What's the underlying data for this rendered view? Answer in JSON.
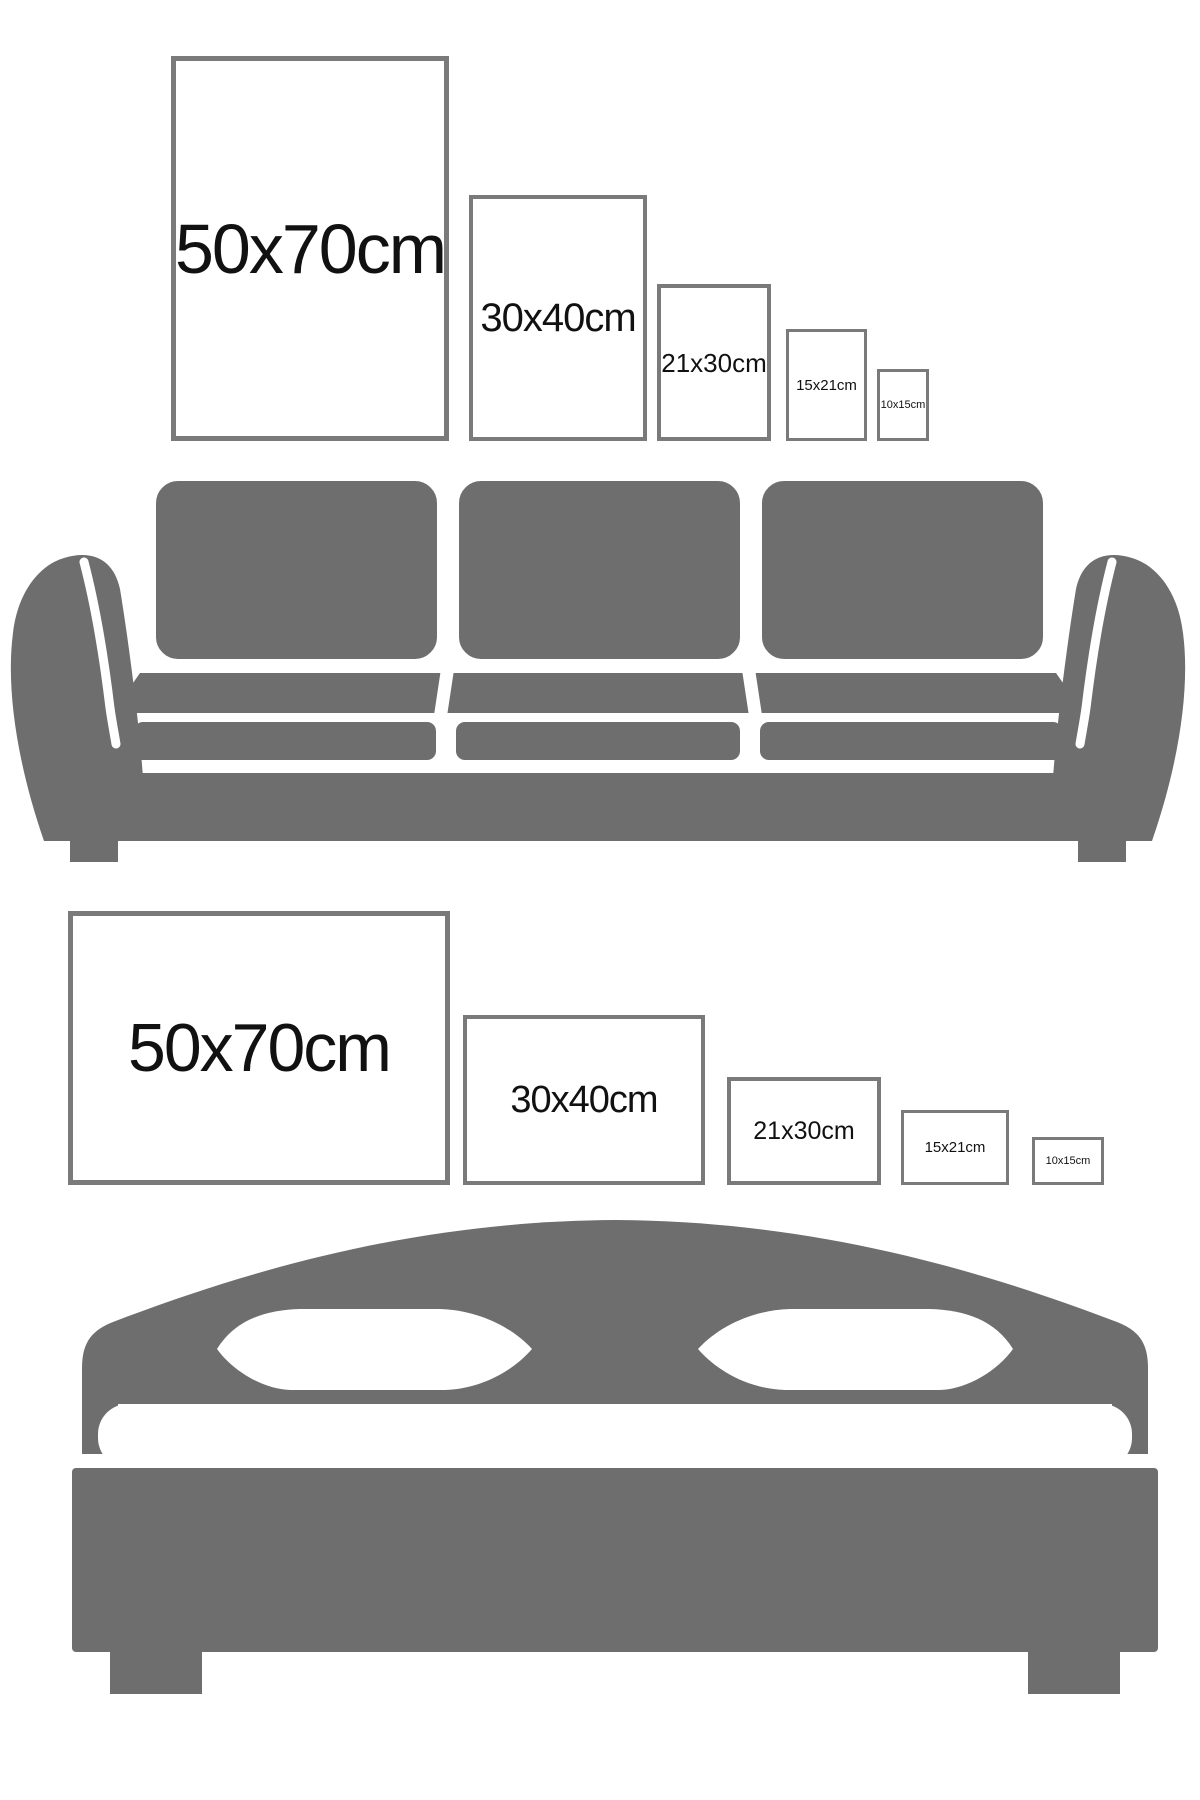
{
  "palette": {
    "furniture_gray": "#6e6e6e",
    "frame_border": "#7a7a7a",
    "text": "#111111",
    "background": "#ffffff"
  },
  "top_row": {
    "orientation": "portrait",
    "frames": [
      {
        "label": "50x70cm"
      },
      {
        "label": "30x40cm"
      },
      {
        "label": "21x30cm"
      },
      {
        "label": "15x21cm"
      },
      {
        "label": "10x15cm"
      }
    ]
  },
  "bottom_row": {
    "orientation": "landscape",
    "frames": [
      {
        "label": "50x70cm"
      },
      {
        "label": "30x40cm"
      },
      {
        "label": "21x30cm"
      },
      {
        "label": "15x21cm"
      },
      {
        "label": "10x15cm"
      }
    ]
  },
  "illustrations": [
    {
      "name": "sofa-icon"
    },
    {
      "name": "bed-icon"
    }
  ]
}
